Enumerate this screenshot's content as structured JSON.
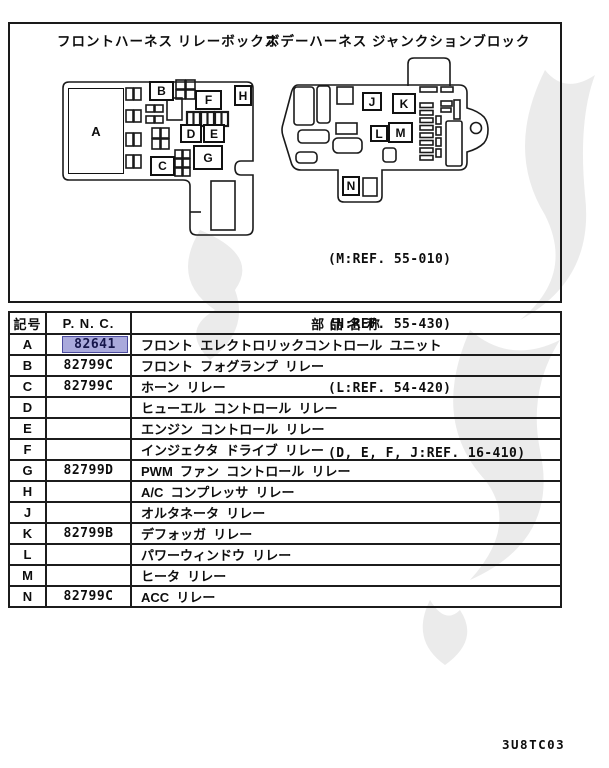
{
  "diagram": {
    "left_title": "フロントハーネス リレーボックス",
    "right_title": "ボデーハーネス ジャンクションブロック",
    "labels": {
      "a": "A",
      "b": "B",
      "c": "C",
      "d": "D",
      "e": "E",
      "f": "F",
      "g": "G",
      "h": "H",
      "j": "J",
      "k": "K",
      "l": "L",
      "m": "M",
      "n": "N"
    },
    "refs": [
      "(M:REF. 55-010)",
      "(H:REF. 55-430)",
      "(L:REF. 54-420)",
      "(D, E, F, J:REF. 16-410)"
    ]
  },
  "table": {
    "headers": {
      "symbol": "記号",
      "pnc": "P. N. C.",
      "name": "部 品 名 称"
    },
    "highlight_color": "#a9a9dc",
    "rows": [
      {
        "symbol": "A",
        "pnc": "82641",
        "name": "フロント  エレクトロリックコントロール  ユニット",
        "highlighted": true
      },
      {
        "symbol": "B",
        "pnc": "82799C",
        "name": "フロント  フォグランプ  リレー",
        "highlighted": false
      },
      {
        "symbol": "C",
        "pnc": "82799C",
        "name": "ホーン  リレー",
        "highlighted": false
      },
      {
        "symbol": "D",
        "pnc": "",
        "name": "ヒューエル  コントロール  リレー",
        "highlighted": false
      },
      {
        "symbol": "E",
        "pnc": "",
        "name": "エンジン  コントロール  リレー",
        "highlighted": false
      },
      {
        "symbol": "F",
        "pnc": "",
        "name": "インジェクタ  ドライブ  リレー",
        "highlighted": false
      },
      {
        "symbol": "G",
        "pnc": "82799D",
        "name": "PWM  ファン  コントロール  リレー",
        "highlighted": false
      },
      {
        "symbol": "H",
        "pnc": "",
        "name": "A/C  コンプレッサ  リレー",
        "highlighted": false
      },
      {
        "symbol": "J",
        "pnc": "",
        "name": "オルタネータ  リレー",
        "highlighted": false
      },
      {
        "symbol": "K",
        "pnc": "82799B",
        "name": "デフォッガ  リレー",
        "highlighted": false
      },
      {
        "symbol": "L",
        "pnc": "",
        "name": "パワーウィンドウ  リレー",
        "highlighted": false
      },
      {
        "symbol": "M",
        "pnc": "",
        "name": "ヒータ  リレー",
        "highlighted": false
      },
      {
        "symbol": "N",
        "pnc": "82799C",
        "name": "ACC  リレー",
        "highlighted": false
      }
    ]
  },
  "page": {
    "footer_code": "3U8TC03"
  }
}
